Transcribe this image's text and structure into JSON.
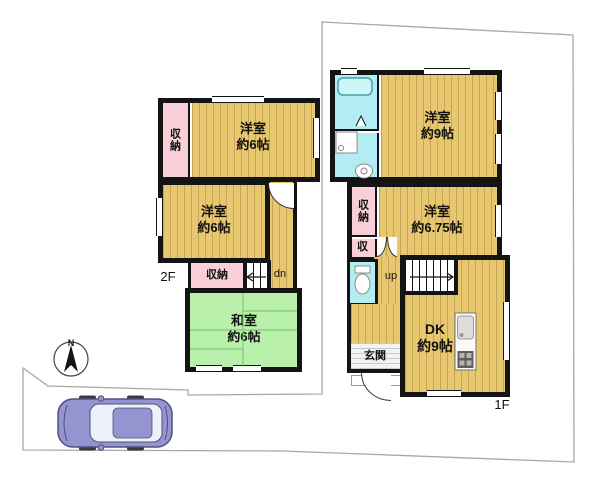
{
  "page": {
    "title": "間取り図 (floor plan)"
  },
  "colors": {
    "wall": "#141414",
    "floor": "#e7c76f",
    "closet": "#f8cfd8",
    "tatami": "#b9f0ab",
    "bath": "#b4edf1",
    "car": "#9494d0",
    "car_edge": "#50507e",
    "boundary": "#a8a8a8"
  },
  "floor2": {
    "floor_label": "2F",
    "room1": {
      "name": "洋室",
      "size": "約6帖"
    },
    "room2": {
      "name": "洋室",
      "size": "約6帖"
    },
    "washitsu": {
      "name": "和室",
      "size": "約6帖"
    },
    "closet_side": "収納",
    "closet_bottom": "収納",
    "stairs_label": "dn"
  },
  "floor1": {
    "floor_label": "1F",
    "room1": {
      "name": "洋室",
      "size": "約9帖"
    },
    "room2": {
      "name": "洋室",
      "size": "約6.75帖"
    },
    "dk": {
      "name": "DK",
      "size": "約9帖"
    },
    "closet_side": "収納",
    "closet_small": "収",
    "genkan": "玄関",
    "stairs_label": "up"
  },
  "compass": {
    "north_label": "N"
  }
}
